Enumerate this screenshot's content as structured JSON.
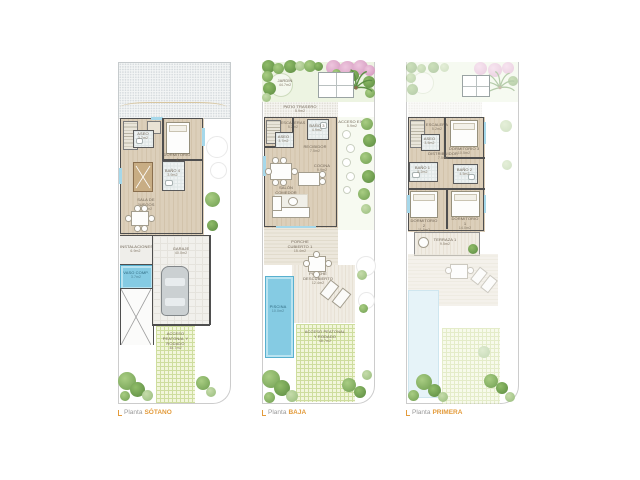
{
  "figure": {
    "type": "architectural-floor-plans",
    "accent_color": "#e39b3b",
    "wall_color": "#4f4f4f",
    "pool_color": "#85cbe3",
    "wood_color": "#d6c8b2",
    "lawn_color": "#f2f6db"
  },
  "icons": [
    "palm-tree-icon",
    "bush-icon",
    "flower-bush-icon",
    "bed-icon",
    "car-icon",
    "stairs-icon",
    "pool-icon",
    "billiard-table-icon",
    "dining-table-icon",
    "sofa-icon",
    "lounger-icon",
    "pergola-icon",
    "stepping-stone-icon",
    "ramp-icon"
  ],
  "captions": {
    "prefix": "Planta",
    "sotano": "SÓTANO",
    "baja": "BAJA",
    "primera": "PRIMERA"
  },
  "plans": {
    "sotano": {
      "rooms": [
        {
          "name": "ASEO",
          "area": "3.7m2"
        },
        {
          "name": "DORMITORIO 4",
          "area": "9.5m2"
        },
        {
          "name": "BAÑO 4",
          "area": "3.9m2"
        },
        {
          "name": "SALA DE JUEGOS",
          "area": "19.5m2"
        },
        {
          "name": "INSTALACIONES",
          "area": "6.9m2"
        },
        {
          "name": "VASO COMP.",
          "area": "3.7m2"
        },
        {
          "name": "GARAJE",
          "area": "40.0m2"
        },
        {
          "name": "ACCESO PEATONAL Y RODADO",
          "area": "48.7m2"
        }
      ]
    },
    "baja": {
      "rooms": [
        {
          "name": "JARDÍN",
          "area": "44.7m2"
        },
        {
          "name": "PATIO TRASERO",
          "area": "5.9m2"
        },
        {
          "name": "ESCALERAS",
          "area": "5.2m2"
        },
        {
          "name": "ASEO",
          "area": "3.7m2"
        },
        {
          "name": "BAÑO 3",
          "area": "4.9m2"
        },
        {
          "name": "RECIBIDOR",
          "area": "7.5m2"
        },
        {
          "name": "ACCESO EXT.",
          "area": "5.9m2"
        },
        {
          "name": "SALÓN COMEDOR",
          "area": "17.8m2"
        },
        {
          "name": "COCINA",
          "area": "9.9m2"
        },
        {
          "name": "PORCHE CUBIERTO 1",
          "area": "15.4m2"
        },
        {
          "name": "PORCHE DESCUBIERTO",
          "area": "12.4m2"
        },
        {
          "name": "PISCINA",
          "area": "10.0m2"
        },
        {
          "name": "ACCESO PEATONAL Y RODADO",
          "area": "48.7m2"
        }
      ]
    },
    "primera": {
      "rooms": [
        {
          "name": "ESCALERA",
          "area": "5.2m2"
        },
        {
          "name": "ASEO",
          "area": "3.5m2"
        },
        {
          "name": "DISTRIBUIDOR",
          "area": "7.5m2"
        },
        {
          "name": "DORMITORIO 3",
          "area": "10.5m2"
        },
        {
          "name": "BAÑO 1",
          "area": "5.2m2"
        },
        {
          "name": "BAÑO 2",
          "area": "4.5m2"
        },
        {
          "name": "DORMITORIO 2",
          "area": "11.5m2"
        },
        {
          "name": "DORMITORIO 1",
          "area": "14.0m2"
        },
        {
          "name": "TERRAZA 1",
          "area": "9.5m2"
        }
      ]
    }
  }
}
